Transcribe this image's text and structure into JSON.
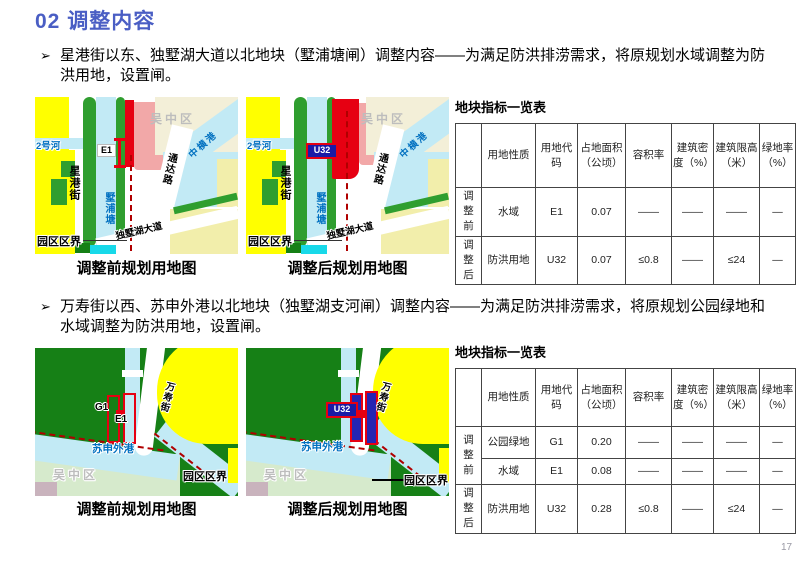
{
  "slide": {
    "title": "02 调整内容",
    "page_number": "17"
  },
  "colors": {
    "title_accent": "#4a5ec4",
    "map_yellow": "#ffff00",
    "map_pale_yellow": "#f2eeab",
    "map_green": "#2f9e2f",
    "map_dark_green": "#168016",
    "map_water": "#c2eaf5",
    "map_red": "#e60012",
    "map_pink": "#f2a8a8",
    "boundary_dash_red": "#b00000",
    "code_box_navy": "#1a1aa6"
  },
  "s1": {
    "marker": "➢",
    "bullet": "星港街以东、独墅湖大道以北地块（墅浦塘闸）调整内容——为满足防洪排涝需求，将原规划水域调整为防洪用地，设置闸。",
    "map_before": {
      "caption": "调整前规划用地图",
      "district": "吴中区",
      "river2": "2号河",
      "street": "星港街",
      "pond": "墅浦塘",
      "road_tongda": "通达路",
      "river_zhongheng": "中横港",
      "avenue": "独墅湖大道",
      "boundary": "园区区界",
      "plot_code": "E1"
    },
    "map_after": {
      "caption": "调整后规划用地图",
      "district": "吴中区",
      "river2": "2号河",
      "street": "星港街",
      "pond": "墅浦塘",
      "road_tongda": "通达路",
      "river_zhongheng": "中横港",
      "avenue": "独墅湖大道",
      "boundary": "园区区界",
      "plot_code": "U32"
    },
    "table": {
      "title": "地块指标一览表",
      "headers": [
        "",
        "用地性质",
        "用地代码",
        "占地面积（公顷）",
        "容积率",
        "建筑密度（%）",
        "建筑限高（米）",
        "绿地率（%）"
      ],
      "rows": [
        {
          "stage": "调整前",
          "nature": "水域",
          "code": "E1",
          "area": "0.07",
          "far": "——",
          "density": "——",
          "limit": "——",
          "green": "—"
        },
        {
          "stage": "调整后",
          "nature": "防洪用地",
          "code": "U32",
          "area": "0.07",
          "far": "≤0.8",
          "density": "——",
          "limit": "≤24",
          "green": "—"
        }
      ]
    }
  },
  "s2": {
    "marker": "➢",
    "bullet": "万寿街以西、苏申外港以北地块（独墅湖支河闸）调整内容——为满足防洪排涝需求，将原规划公园绿地和水域调整为防洪用地，设置闸。",
    "map_before": {
      "caption": "调整前规划用地图",
      "district": "吴中区",
      "street": "万寿街",
      "river": "苏申外港",
      "boundary": "园区区界",
      "plot_code_g": "G1",
      "plot_code_e": "E1"
    },
    "map_after": {
      "caption": "调整后规划用地图",
      "district": "吴中区",
      "street": "万寿街",
      "river": "苏申外港",
      "boundary": "园区区界",
      "plot_code": "U32"
    },
    "table": {
      "title": "地块指标一览表",
      "headers": [
        "",
        "用地性质",
        "用地代码",
        "占地面积（公顷）",
        "容积率",
        "建筑密度（%）",
        "建筑限高（米）",
        "绿地率（%）"
      ],
      "rows": [
        {
          "stage": "调整前",
          "nature": "公园绿地",
          "code": "G1",
          "area": "0.20",
          "far": "——",
          "density": "——",
          "limit": "——",
          "green": "—"
        },
        {
          "nature": "水域",
          "code": "E1",
          "area": "0.08",
          "far": "——",
          "density": "——",
          "limit": "——",
          "green": "—"
        },
        {
          "stage": "调整后",
          "nature": "防洪用地",
          "code": "U32",
          "area": "0.28",
          "far": "≤0.8",
          "density": "——",
          "limit": "≤24",
          "green": "—"
        }
      ]
    }
  }
}
